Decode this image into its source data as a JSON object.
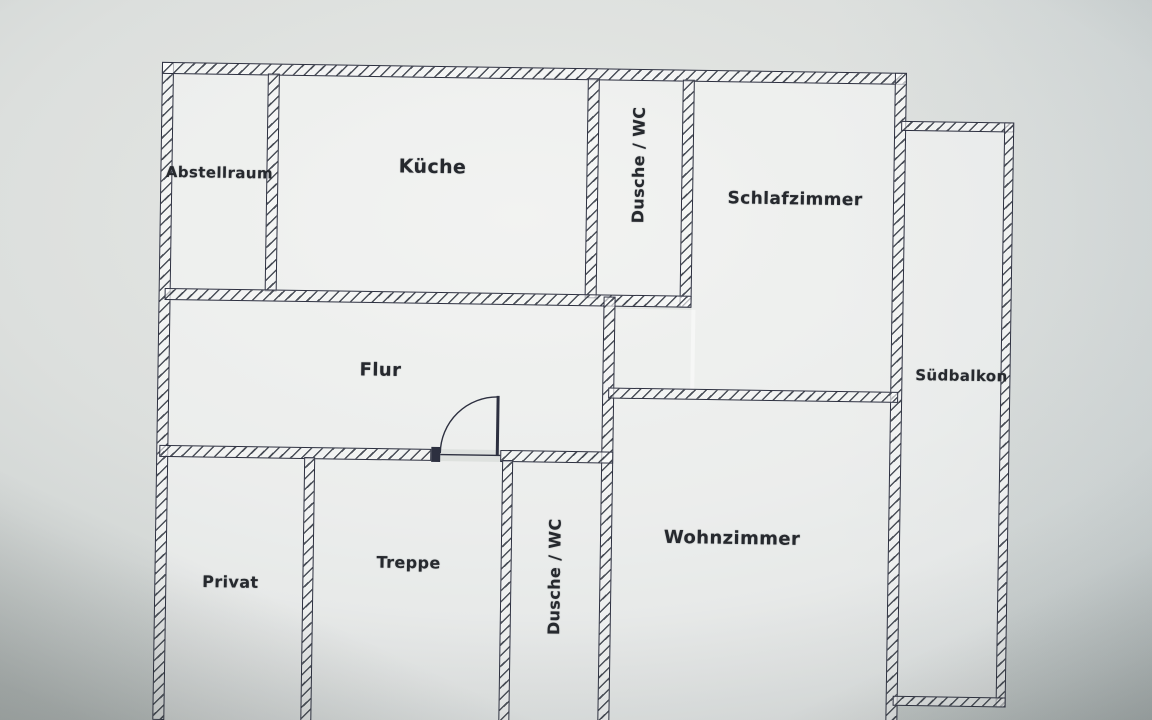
{
  "floorplan": {
    "rooms": {
      "abstellraum": {
        "label": "Abstellraum"
      },
      "kueche": {
        "label": "Küche"
      },
      "dusche_wc_oben": {
        "label": "Dusche / WC"
      },
      "schlafzimmer": {
        "label": "Schlafzimmer"
      },
      "suedbalkon": {
        "label": "Südbalkon"
      },
      "flur": {
        "label": "Flur"
      },
      "privat": {
        "label": "Privat"
      },
      "treppe": {
        "label": "Treppe"
      },
      "dusche_wc_unten": {
        "label": "Dusche / WC"
      },
      "wohnzimmer": {
        "label": "Wohnzimmer"
      }
    },
    "colors": {
      "paper": "#cdd2d1",
      "room_fill": "rgba(255,255,255,0.45)",
      "wall_fill": "rgba(255,255,255,0.62)",
      "wall_line": "#2d3040",
      "hatch_line": "#4a4f58",
      "label_text": "#26292e"
    }
  }
}
